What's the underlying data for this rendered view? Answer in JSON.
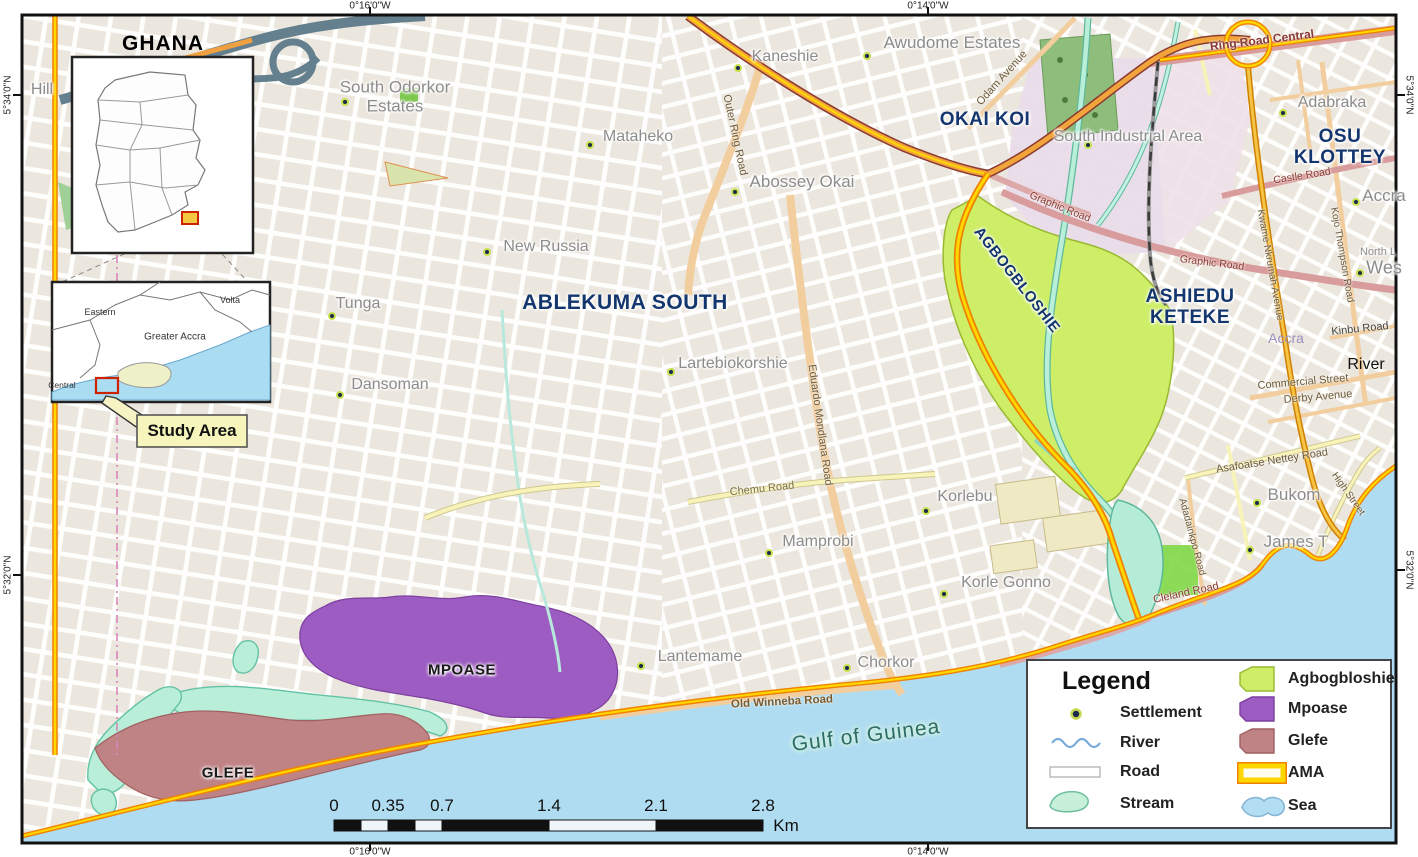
{
  "frame": {
    "coords": {
      "top": [
        "0°16'0\"W",
        "0°14'0\"W"
      ],
      "bottom": [
        "0°16'0\"W",
        "0°14'0\"W"
      ],
      "left": [
        "5°34'0\"N",
        "5°32'0\"N"
      ],
      "right": [
        "5°34'0\"N",
        "5°32'0\"N"
      ]
    }
  },
  "insets": {
    "ghana": {
      "title": "GHANA"
    },
    "region": {
      "eastern": "Eastern",
      "volta": "Volta",
      "greater_accra": "Greater Accra",
      "central": "Central"
    },
    "study_area_label": "Study Area"
  },
  "districts": {
    "okai_koi": "OKAI KOI",
    "osu_line1": "OSU",
    "osu_line2": "KLOTTEY",
    "ashiedu_line1": "ASHIEDU",
    "ashiedu_line2": "KETEKE",
    "ablekuma": "ABLEKUMA SOUTH",
    "agbogbloshie": "AGBOGBLOSHIE",
    "mpoase": "MPOASE",
    "glefe": "GLEFE"
  },
  "settlements": [
    "South Odorkor Estates",
    "Mataheko",
    "Kaneshie",
    "Awudome Estates",
    "Abossey Okai",
    "New Russia",
    "Tunga",
    "Dansoman",
    "Lartebiokorshie",
    "Korlebu",
    "Mamprobi",
    "Korle Gonno",
    "Lantemame",
    "Chorkor",
    "Bukom",
    "James T",
    "Adabraka",
    "South Industrial Area",
    "Accra",
    "Accra",
    "Hill",
    "North L",
    "Wes"
  ],
  "water": {
    "gulf": "Gulf of Guinea",
    "river_label": "River"
  },
  "roads": [
    "Outer Ring Road",
    "Odam Avenue",
    "Ring Road Central",
    "Graphic Road",
    "Graphic Road",
    "Castle Road",
    "Kinbu Road",
    "Commercial Street",
    "Derby Avenue",
    "Asafoatse Nettey Road",
    "Adadainkpo Road",
    "Cleland Road",
    "High Street",
    "Chemu Road",
    "Old Winneba Road",
    "Eduardo Mondlana Road",
    "Kwame Nkrumah Avenue",
    "Kojo Thompson Road"
  ],
  "legend": {
    "title": "Legend",
    "items_left": [
      {
        "label": "Settlement"
      },
      {
        "label": "River"
      },
      {
        "label": "Road"
      },
      {
        "label": "Stream"
      }
    ],
    "items_right": [
      {
        "label": "Agbogbloshie"
      },
      {
        "label": "Mpoase"
      },
      {
        "label": "Glefe"
      },
      {
        "label": "AMA"
      },
      {
        "label": "Sea"
      }
    ]
  },
  "scalebar": {
    "ticks": [
      "0",
      "0.35",
      "0.7",
      "1.4",
      "2.1",
      "2.8"
    ],
    "unit": "Km"
  },
  "colors": {
    "agbogbloshie": "#cdee66",
    "mpoase": "#9d5cc1",
    "glefe": "#bf8285",
    "sea": "#b0dcf2",
    "stream": "#b9efd9",
    "ama_yellow": "#ffd700",
    "ama_orange": "#ef8200",
    "district_label": "#14366e"
  }
}
